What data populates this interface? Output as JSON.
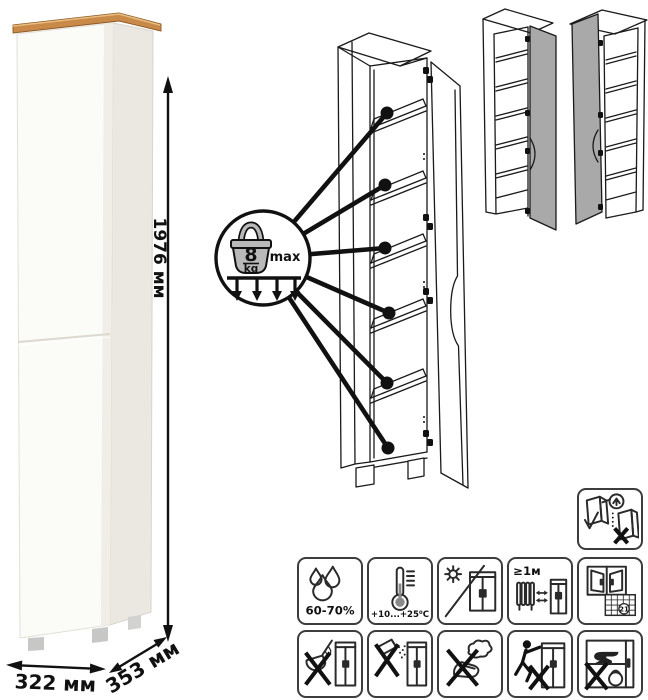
{
  "dimensions": {
    "height": "1976 мм",
    "width": "322 мм",
    "depth": "353 мм"
  },
  "load_limit": {
    "value": "8",
    "unit": "kg",
    "qualifier": "max"
  },
  "care": {
    "humidity": "60-70%",
    "temperature": "+10...+25⁰C",
    "heat_distance": "≥1м",
    "calendar_day": "21"
  },
  "icon_legend": [
    "humidity-icon",
    "temperature-icon",
    "no-direct-sunlight-icon",
    "heat-distance-icon",
    "ventilation-icon",
    "no-liquids-icon",
    "no-powder-icon",
    "no-wet-cloth-icon",
    "no-dragging-icon",
    "no-overload-icon",
    "wall-mount-icon",
    "shelf-load-icon"
  ],
  "colors": {
    "wood_top": "#c98a49",
    "wood_edge": "#8d5a25",
    "cabinet_front": "#fbfbf8",
    "cabinet_side": "#eae8e1",
    "door_gray": "#a9a9a9",
    "weight_gray": "#b9b9b9",
    "line_art": "#1a1a1a"
  }
}
